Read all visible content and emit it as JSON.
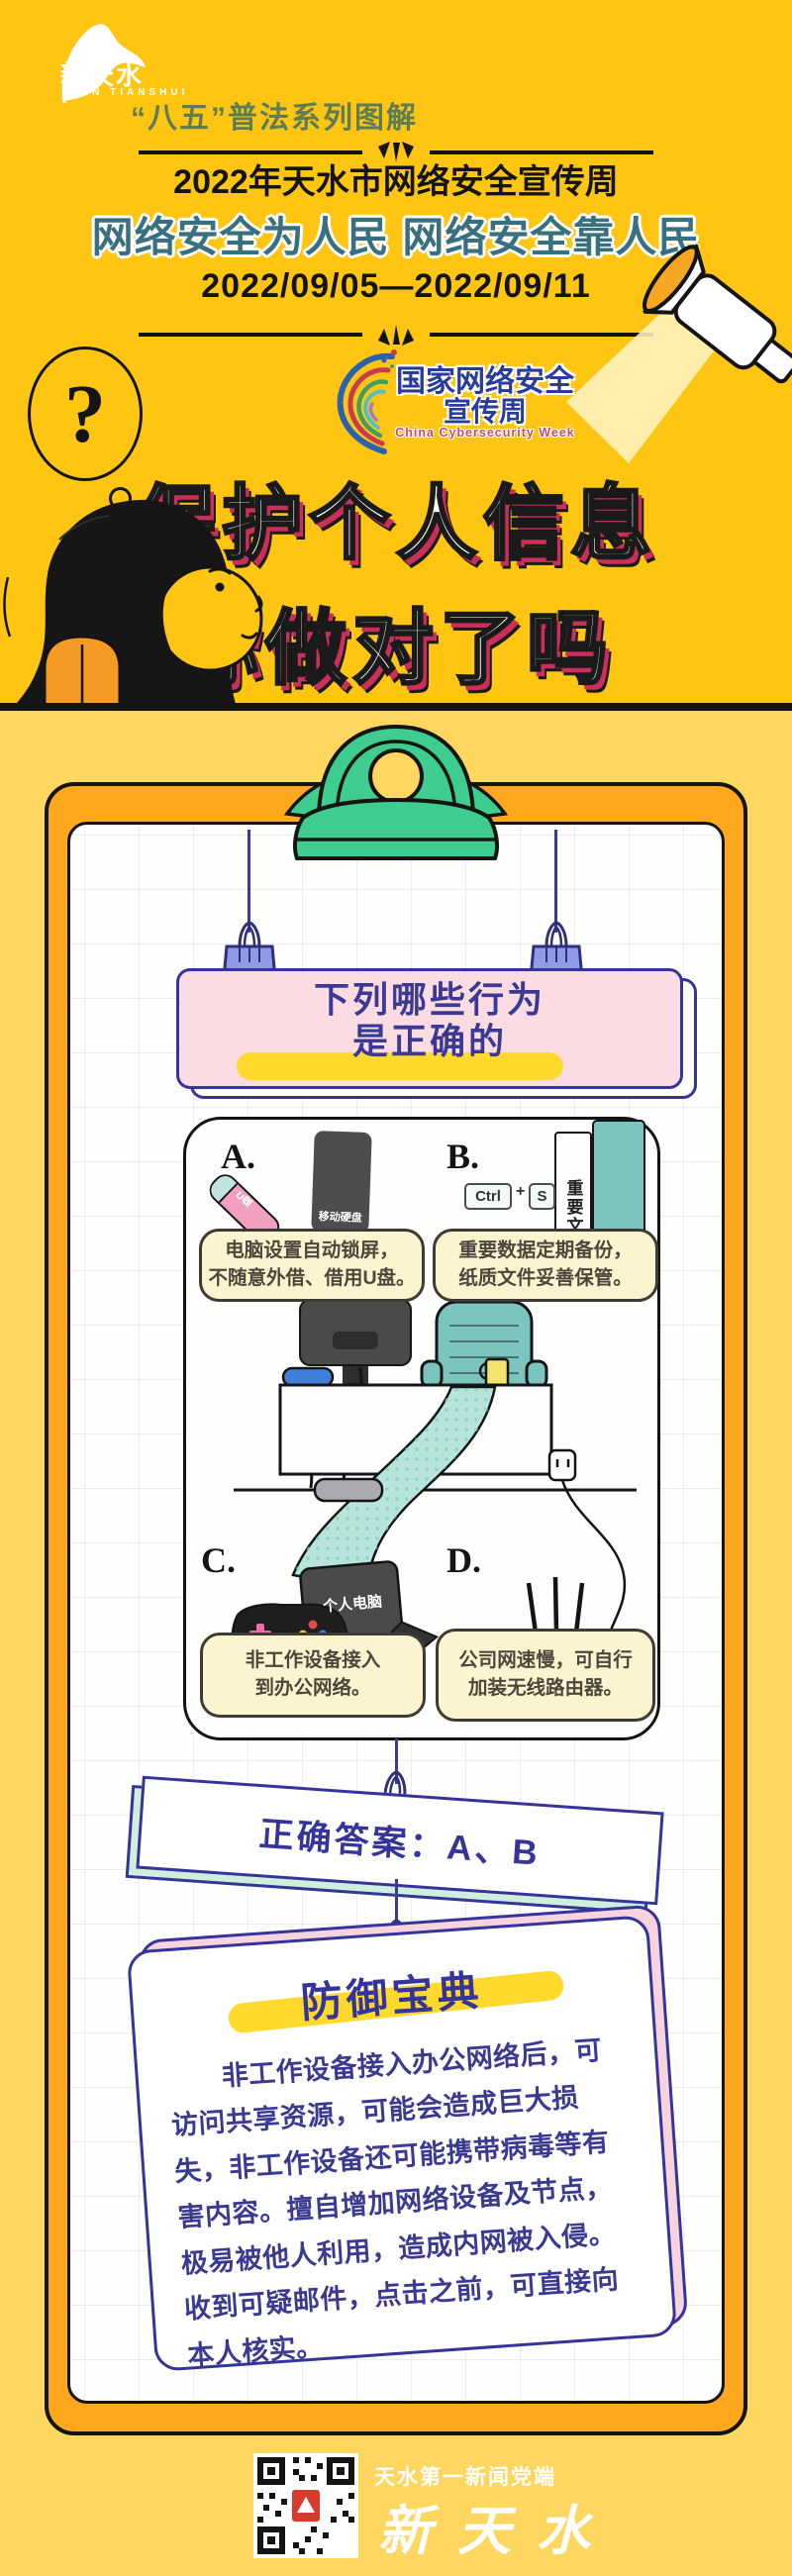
{
  "colors": {
    "bg_top": "#FEC613",
    "bg_bottom": "#FDD75F",
    "board_orange": "#FFA81E",
    "clip_green": "#3ECD8E",
    "navy": "#34349A",
    "hero_shadow": "#C92F58",
    "slogan_teal": "#39707F",
    "bubble_cream": "#FCF4CF",
    "card_pink": "#FADCE2"
  },
  "header": {
    "logo_cn": "新天水",
    "logo_en": "XIN TIANSHUI",
    "series": "“八五”普法系列图解"
  },
  "banner": {
    "line1": "2022年天水市网络安全宣传周",
    "slogan": "网络安全为人民  网络安全靠人民",
    "dates": "2022/09/05—2022/09/11"
  },
  "week_logo": {
    "line1": "国家网络安全",
    "line2": "宣传周",
    "en": "China Cybersecurity Week"
  },
  "hero": {
    "question_mark": "?",
    "title_line1": "保护个人信息",
    "title_line2": "你做对了吗"
  },
  "quiz": {
    "question_line1": "下列哪些行为",
    "question_line2": "是正确的",
    "options": [
      {
        "label": "A.",
        "line1": "电脑设置自动锁屏，",
        "line2": "不随意外借、借用U盘。",
        "usb_label": "U盘",
        "drive_label": "移动硬盘"
      },
      {
        "label": "B.",
        "line1": "重要数据定期备份，",
        "line2": "纸质文件妥善保管。",
        "key1": "Ctrl",
        "plus": "+",
        "key2": "S",
        "book_label": "重要文件"
      },
      {
        "label": "C.",
        "line1": "非工作设备接入",
        "line2": "到办公网络。",
        "laptop_label": "个人电脑"
      },
      {
        "label": "D.",
        "line1": "公司网速慢，可自行",
        "line2": "加装无线路由器。"
      }
    ],
    "answer": "正确答案：A、B"
  },
  "guide": {
    "title": "防御宝典",
    "body": "非工作设备接入办公网络后，可访问共享资源，可能会造成巨大损失，非工作设备还可能携带病毒等有害内容。擅自增加网络设备及节点，极易被他人利用，造成内网被入侵。收到可疑邮件，点击之前，可直接向本人核实。"
  },
  "footer": {
    "tagline": "天水第一新闻党端",
    "brand": "新天水"
  }
}
